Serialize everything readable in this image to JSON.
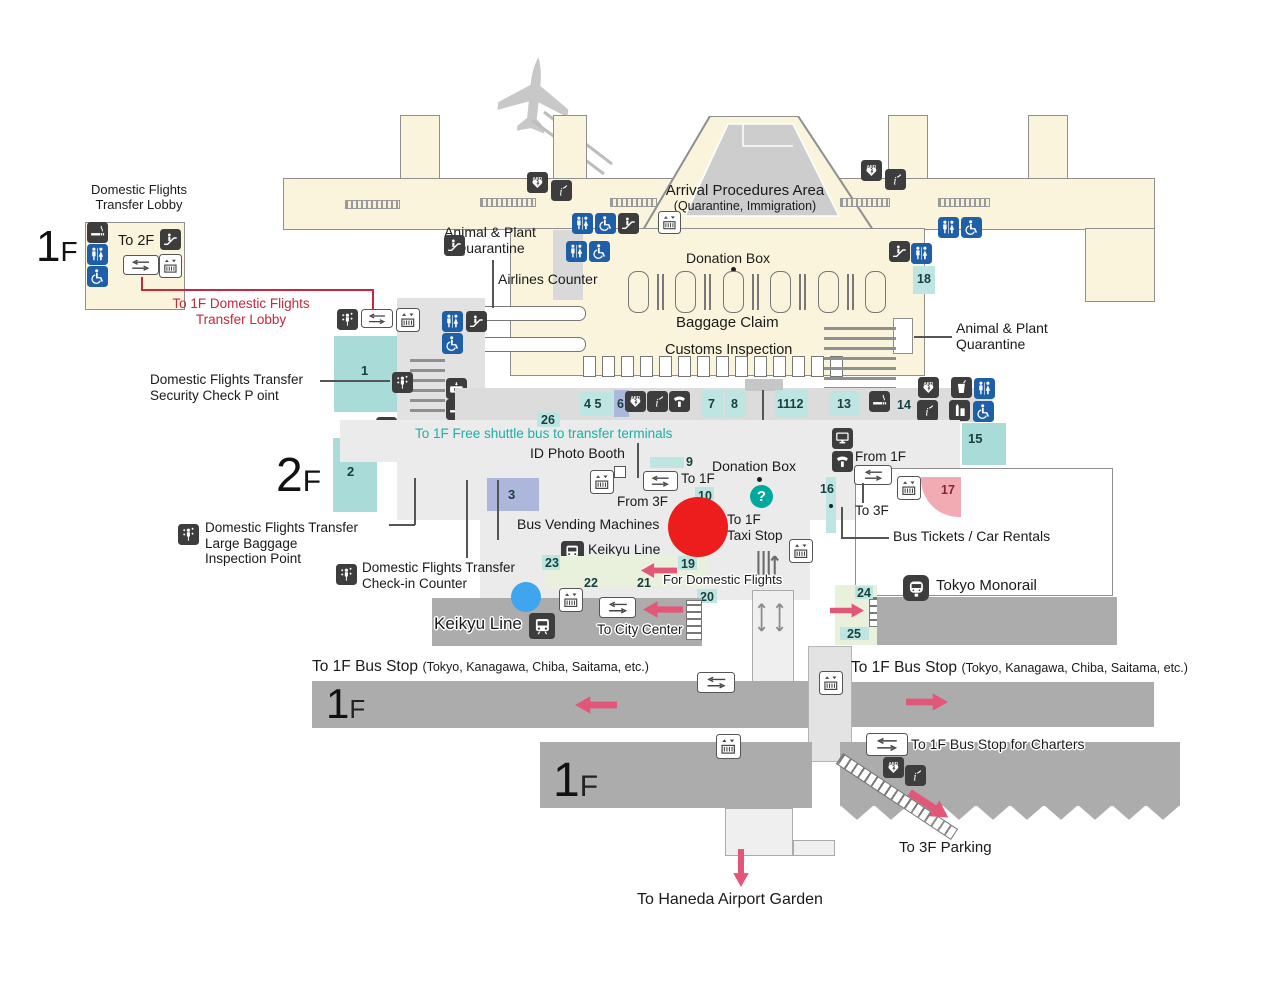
{
  "icon_texts": {
    "aed": "AED",
    "question": "?",
    "info": "i"
  },
  "markers": {
    "red_circle_color": "#ED1D1D",
    "blue_circle_color": "#3EA5EE"
  },
  "transfer_lobby_1f": {
    "title_line1": "Domestic Flights",
    "title_line2": "Transfer Lobby",
    "floor_number": "1",
    "floor_letter": "F",
    "to_2f": "To 2F",
    "red_note_line1": "To 1F Domestic Flights",
    "red_note_line2": "Transfer Lobby"
  },
  "terminal_top": {
    "arrival_procedures_line1": "Arrival Procedures Area",
    "arrival_procedures_line2": "(Quarantine, Immigration)"
  },
  "baggage_hall": {
    "animal_left_line1": "Animal & Plant",
    "animal_left_line2": "Quarantine",
    "airlines_counter": "Airlines Counter",
    "donation_box": "Donation Box",
    "baggage_claim": "Baggage Claim",
    "customs_inspection": "Customs Inspection",
    "animal_right_line1": "Animal & Plant",
    "animal_right_line2": "Quarantine",
    "num_18": "18"
  },
  "floor_2f": {
    "floor_number": "2",
    "floor_letter": "F",
    "security_line1": "Domestic Flights Transfer",
    "security_line2": "Security Check P oint",
    "large_baggage_line1": "Domestic Flights Transfer",
    "large_baggage_line2": "Large Baggage",
    "large_baggage_line3": "Inspection Point",
    "checkin_line1": "Domestic Flights Transfer",
    "checkin_line2": "Check-in Counter",
    "num_1": "1",
    "num_2": "2",
    "num_3": "3",
    "num_26": "26",
    "shuttle_note": "To 1F Free shuttle bus to transfer terminals",
    "id_photo_booth": "ID Photo Booth"
  },
  "arrival_strip": {
    "num_4": "4",
    "num_5": "5",
    "num_6": "6",
    "num_7": "7",
    "num_8": "8",
    "num_11": "11",
    "num_12": "12",
    "num_13": "13",
    "num_14": "14",
    "num_15": "15",
    "arrival_exit": "Arrival Exit"
  },
  "concourse": {
    "num_9": "9",
    "num_10": "10",
    "num_16": "16",
    "num_17": "17",
    "to_1f": "To 1F",
    "from_3f": "From 3F",
    "donation_box": "Donation Box",
    "taxi_line1": "To 1F",
    "taxi_line2": "Taxi Stop",
    "from_1f": "From 1F",
    "to_3f": "To 3F",
    "bus_tickets_car_rentals": "Bus Tickets / Car Rentals",
    "bus_vending_machines": "Bus Vending Machines",
    "keikyu_line": "Keikyu Line",
    "num_19": "19",
    "num_20": "20",
    "num_21": "21",
    "num_22": "22",
    "num_23": "23",
    "for_domestic_flights": "For Domestic Flights"
  },
  "keikyu_band": {
    "keikyu_line": "Keikyu Line",
    "to_city_center": "To City Center"
  },
  "monorail_band": {
    "tokyo_monorail": "Tokyo Monorail",
    "num_24": "24",
    "num_25": "25"
  },
  "bus_level": {
    "left_stop": "To 1F Bus Stop",
    "left_stop_detail": "(Tokyo, Kanagawa, Chiba, Saitama, etc.)",
    "right_stop": "To 1F Bus Stop",
    "right_stop_detail": "(Tokyo, Kanagawa, Chiba, Saitama, etc.)",
    "floor_number": "1",
    "floor_letter": "F",
    "charters": "To 1F Bus Stop for Charters"
  },
  "lower_level": {
    "floor_number": "1",
    "floor_letter": "F",
    "parking": "To 3F Parking",
    "garden": "To Haneda Airport Garden"
  }
}
